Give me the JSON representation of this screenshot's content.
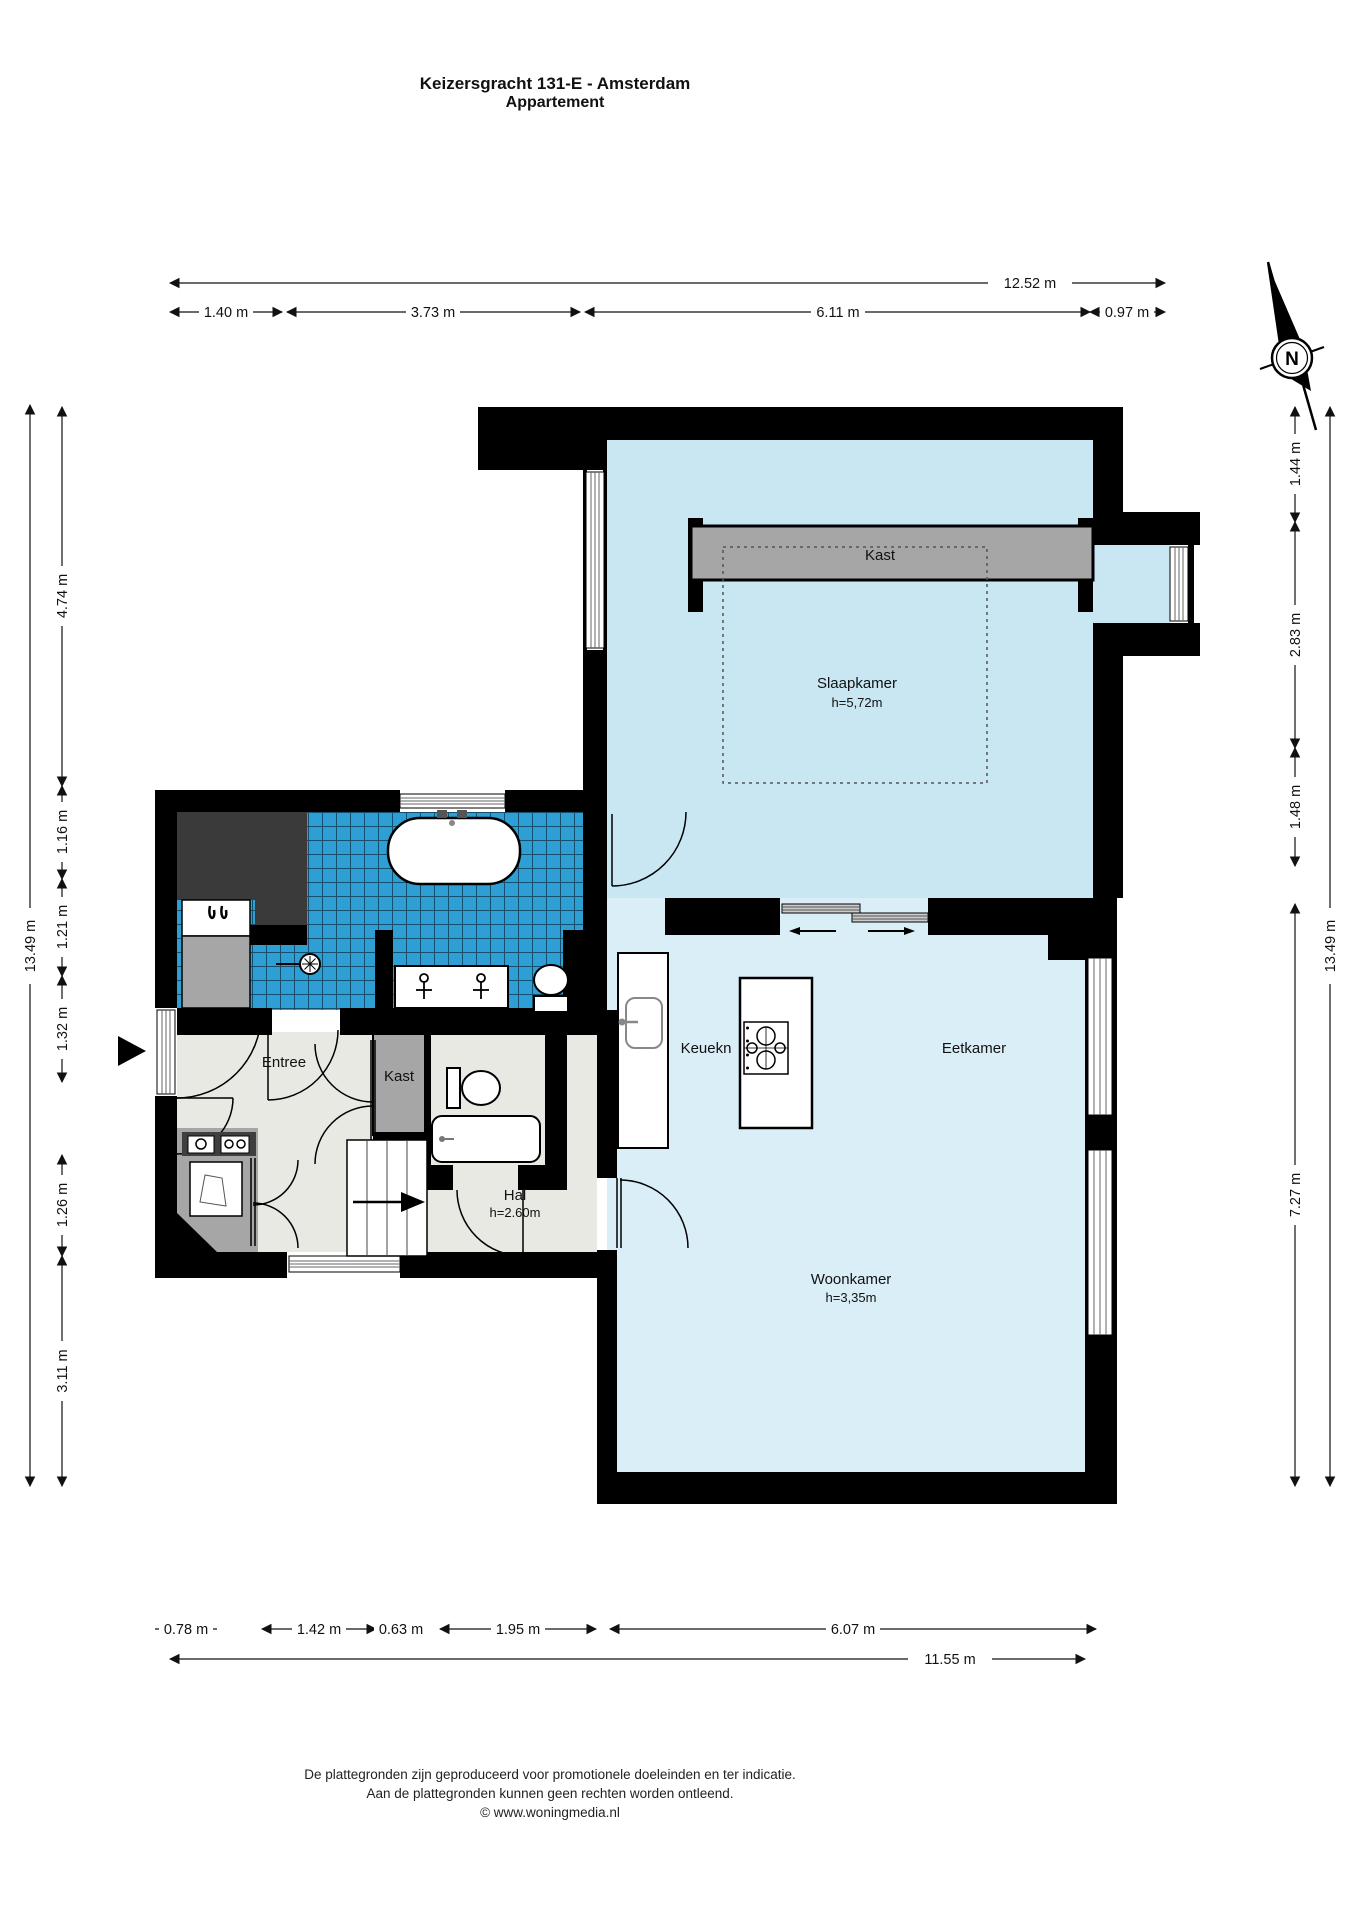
{
  "title": {
    "line1": "Keizersgracht 131-E - Amsterdam",
    "line2": "Appartement"
  },
  "compass": {
    "north_label": "N"
  },
  "rooms": {
    "slaapkamer": {
      "name": "Slaapkamer",
      "height": "h=5,72m"
    },
    "kast_slaapkamer": {
      "name": "Kast"
    },
    "entree": {
      "name": "Entree"
    },
    "kast_hal": {
      "name": "Kast"
    },
    "hal": {
      "name": "Hal",
      "height": "h=2.60m"
    },
    "keuken": {
      "name": "Keuekn"
    },
    "eetkamer": {
      "name": "Eetkamer"
    },
    "woonkamer": {
      "name": "Woonkamer",
      "height": "h=3,35m"
    }
  },
  "dimensions": {
    "top": {
      "total": "12.52 m",
      "segments": [
        "1.40 m",
        "3.73 m",
        "6.11 m",
        "0.97 m"
      ]
    },
    "left": {
      "total": "13.49 m",
      "segments": [
        "4.74 m",
        "1.16 m",
        "1.21 m",
        "1.32 m",
        "1.26 m",
        "3.11 m"
      ]
    },
    "right": {
      "total": "13.49 m",
      "segments": [
        "1.44 m",
        "2.83 m",
        "1.48 m",
        "7.27 m"
      ]
    },
    "bottom": {
      "total": "11.55 m",
      "segments": [
        "0.78 m",
        "1.42 m",
        "0.63 m",
        "1.95 m",
        "6.07 m"
      ]
    }
  },
  "footer": {
    "line1": "De plattegronden zijn geproduceerd voor promotionele doeleinden en ter indicatie.",
    "line2": "Aan de plattegronden kunnen geen rechten worden ontleend.",
    "line3": "© www.woningmedia.nl"
  },
  "colors": {
    "wall": "#000000",
    "slaapkamer_floor": "#c9e7f3",
    "woonkamer_floor": "#daeef8",
    "bathroom_tile": "#2e9fd5",
    "tile_grout": "#14506e",
    "hal_floor": "#e9e9e4",
    "closet_gray": "#a6a6a6",
    "dark_area": "#3a3a3a"
  }
}
